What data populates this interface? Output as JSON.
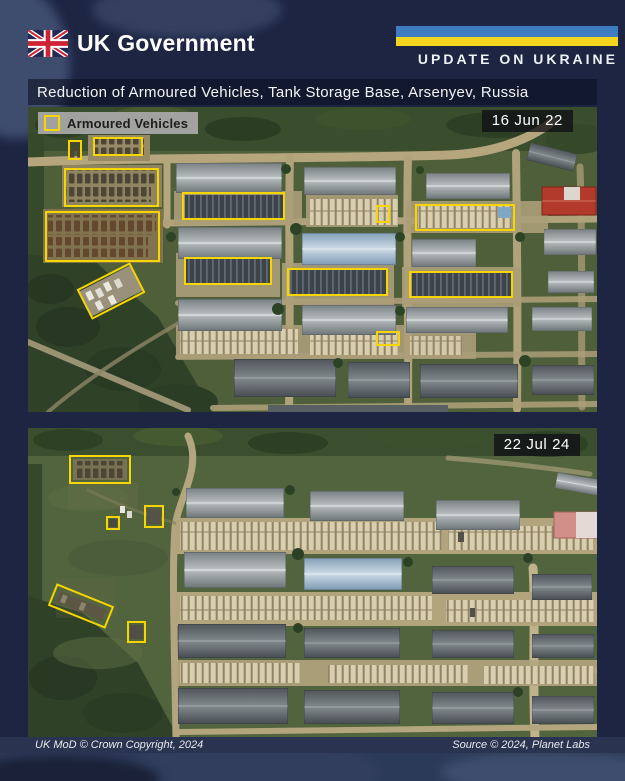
{
  "header": {
    "brand": "UK Government",
    "banner_label": "UPDATE ON UKRAINE"
  },
  "title": "Reduction of Armoured Vehicles, Tank Storage Base,  Arsenyev, Russia",
  "legend": {
    "label": "Armoured Vehicles"
  },
  "colors": {
    "annotation_yellow": "#f6d500",
    "ukraine_blue": "#3f7dc2",
    "ukraine_yellow": "#f5d61f",
    "background_navy": "#1d2543"
  },
  "panels": [
    {
      "name": "before",
      "date": "16 Jun 22",
      "annotations": [
        {
          "x": 40,
          "y": 33,
          "w": 14,
          "h": 20,
          "rot": 0
        },
        {
          "x": 65,
          "y": 30,
          "w": 50,
          "h": 19,
          "rot": 0
        },
        {
          "x": 36,
          "y": 61,
          "w": 95,
          "h": 39,
          "rot": 0
        },
        {
          "x": 17,
          "y": 104,
          "w": 115,
          "h": 51,
          "rot": 0
        },
        {
          "x": 53,
          "y": 167,
          "w": 60,
          "h": 34,
          "rot": -27
        },
        {
          "x": 154,
          "y": 85,
          "w": 103,
          "h": 28,
          "rot": 0
        },
        {
          "x": 156,
          "y": 150,
          "w": 88,
          "h": 28,
          "rot": 0
        },
        {
          "x": 259,
          "y": 161,
          "w": 101,
          "h": 28,
          "rot": 0
        },
        {
          "x": 381,
          "y": 164,
          "w": 104,
          "h": 27,
          "rot": 0
        },
        {
          "x": 348,
          "y": 224,
          "w": 24,
          "h": 15,
          "rot": 0
        },
        {
          "x": 348,
          "y": 98,
          "w": 14,
          "h": 18,
          "rot": 0
        },
        {
          "x": 387,
          "y": 97,
          "w": 100,
          "h": 27,
          "rot": 0
        }
      ]
    },
    {
      "name": "after",
      "date": "22 Jul 24",
      "annotations": [
        {
          "x": 41,
          "y": 27,
          "w": 62,
          "h": 29,
          "rot": 0
        },
        {
          "x": 78,
          "y": 88,
          "w": 14,
          "h": 14,
          "rot": 0
        },
        {
          "x": 116,
          "y": 77,
          "w": 20,
          "h": 23,
          "rot": 0
        },
        {
          "x": 22,
          "y": 166,
          "w": 62,
          "h": 24,
          "rot": 22
        },
        {
          "x": 99,
          "y": 193,
          "w": 19,
          "h": 22,
          "rot": 0
        }
      ]
    }
  ],
  "footer": {
    "left": "UK MoD © Crown Copyright, 2024",
    "right": "Source © 2024,  Planet Labs"
  }
}
